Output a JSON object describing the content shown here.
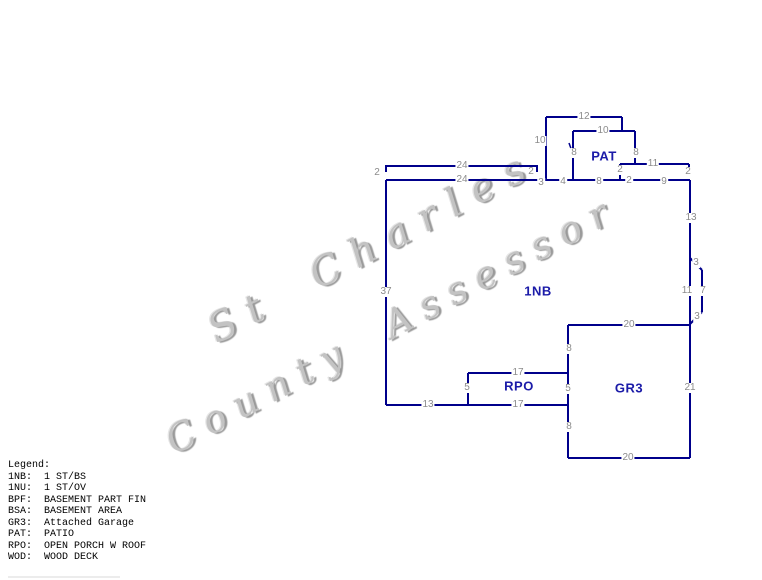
{
  "watermark": {
    "line1": "St Charles",
    "line2": "County Assessor"
  },
  "sketch": {
    "colors": {
      "wall": "#00008b",
      "dim": "#8c8c8c",
      "room": "#1b1ba8"
    },
    "room_labels": [
      {
        "t": "PAT",
        "x": 604,
        "y": 156
      },
      {
        "t": "1NB",
        "x": 538,
        "y": 291
      },
      {
        "t": "RPO",
        "x": 519,
        "y": 386
      },
      {
        "t": "GR3",
        "x": 629,
        "y": 388
      }
    ],
    "dimension_labels": [
      {
        "t": "24",
        "x": 462,
        "y": 166
      },
      {
        "t": "2",
        "x": 377,
        "y": 173
      },
      {
        "t": "2",
        "x": 531,
        "y": 172
      },
      {
        "t": "24",
        "x": 462,
        "y": 180
      },
      {
        "t": "3",
        "x": 541,
        "y": 183
      },
      {
        "t": "4",
        "x": 563,
        "y": 182
      },
      {
        "t": "8",
        "x": 599,
        "y": 182
      },
      {
        "t": "2",
        "x": 620,
        "y": 170
      },
      {
        "t": "2",
        "x": 629,
        "y": 181
      },
      {
        "t": "9",
        "x": 664,
        "y": 182
      },
      {
        "t": "2",
        "x": 688,
        "y": 172
      },
      {
        "t": "10",
        "x": 540,
        "y": 141
      },
      {
        "t": "12",
        "x": 584,
        "y": 117
      },
      {
        "t": "10",
        "x": 603,
        "y": 131
      },
      {
        "t": "8",
        "x": 574,
        "y": 153
      },
      {
        "t": "8",
        "x": 636,
        "y": 153
      },
      {
        "t": "11",
        "x": 653,
        "y": 164
      },
      {
        "t": "13",
        "x": 691,
        "y": 218
      },
      {
        "t": "3",
        "x": 696,
        "y": 263
      },
      {
        "t": "11",
        "x": 687,
        "y": 291
      },
      {
        "t": "7",
        "x": 703,
        "y": 291
      },
      {
        "t": "3",
        "x": 697,
        "y": 317
      },
      {
        "t": "20",
        "x": 629,
        "y": 325
      },
      {
        "t": "21",
        "x": 690,
        "y": 388
      },
      {
        "t": "20",
        "x": 628,
        "y": 458
      },
      {
        "t": "8",
        "x": 569,
        "y": 349
      },
      {
        "t": "5",
        "x": 568,
        "y": 389
      },
      {
        "t": "8",
        "x": 569,
        "y": 427
      },
      {
        "t": "17",
        "x": 518,
        "y": 373
      },
      {
        "t": "5",
        "x": 467,
        "y": 388
      },
      {
        "t": "13",
        "x": 428,
        "y": 405
      },
      {
        "t": "17",
        "x": 518,
        "y": 405
      },
      {
        "t": "37",
        "x": 386,
        "y": 292
      }
    ]
  },
  "legend": {
    "title": "Legend:",
    "entries": [
      {
        "abbr": "1NB:",
        "desc": "1 ST/BS"
      },
      {
        "abbr": "1NU:",
        "desc": "1 ST/OV"
      },
      {
        "abbr": "BPF:",
        "desc": "BASEMENT PART FIN"
      },
      {
        "abbr": "BSA:",
        "desc": "BASEMENT AREA"
      },
      {
        "abbr": "GR3:",
        "desc": "Attached Garage"
      },
      {
        "abbr": "PAT:",
        "desc": "PATIO"
      },
      {
        "abbr": "RPO:",
        "desc": "OPEN PORCH W ROOF"
      },
      {
        "abbr": "WOD:",
        "desc": "WOOD DECK"
      }
    ]
  }
}
